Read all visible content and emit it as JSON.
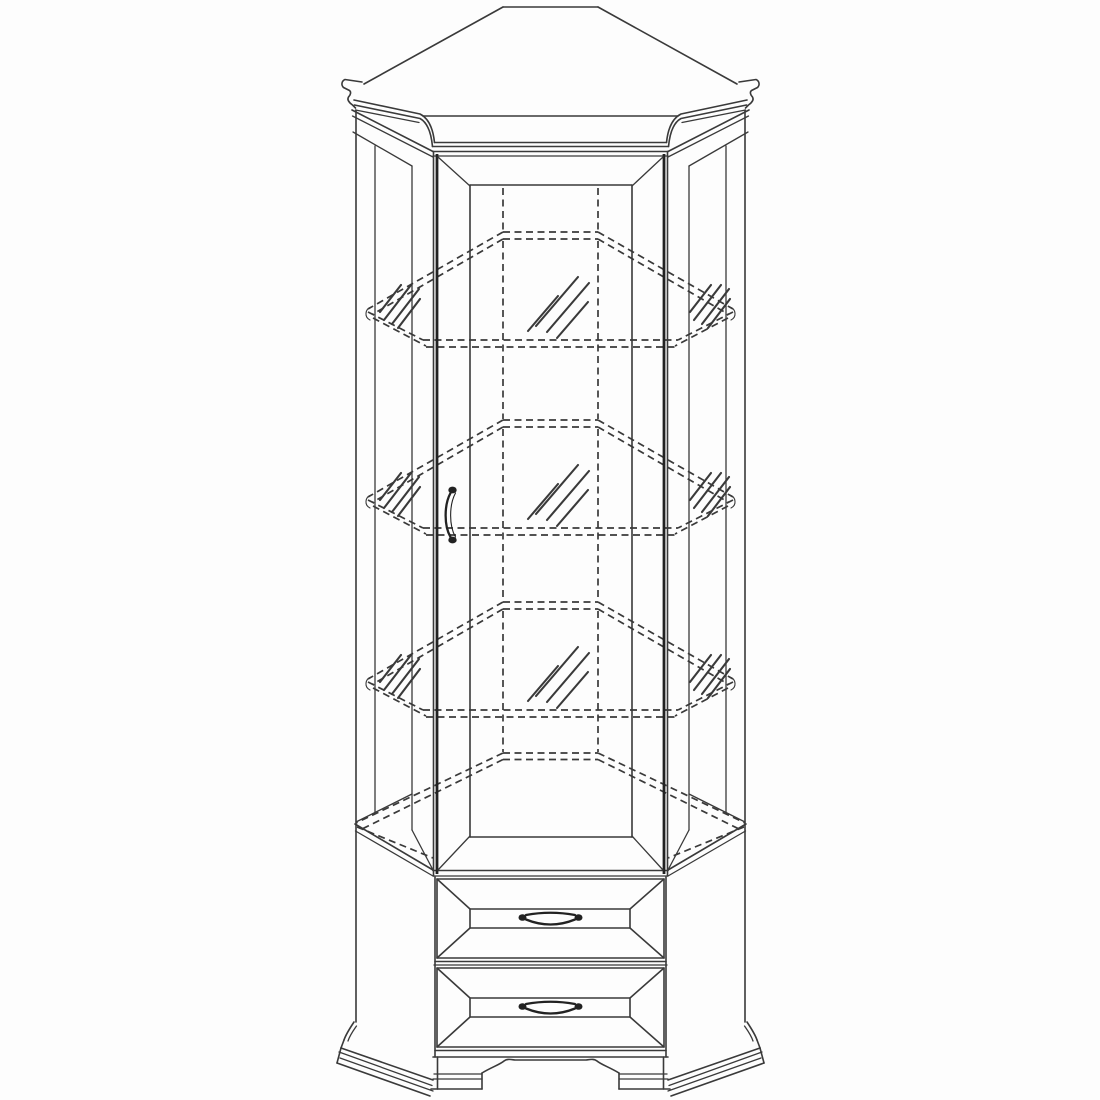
{
  "meta": {
    "document_type": "technical furniture line drawing",
    "subject": "corner display cabinet",
    "view": "front elevation with perspective top",
    "background_color": "#fdfdfd",
    "line_color": "#3a3a3a",
    "dark_line_color": "#222222"
  },
  "cabinet": {
    "crown": {
      "style": "flared cornice with ogee end tips",
      "tip_count": 2
    },
    "door": {
      "count": 1,
      "type": "glazed display door",
      "handle": {
        "type": "curved vertical pull",
        "side": "left",
        "x": 452,
        "y": 515
      }
    },
    "shelves": {
      "count": 3,
      "material": "glass",
      "line_style": "dashed hidden lines",
      "y_offsets": [
        232,
        420,
        602
      ],
      "glass_hatch_groups_per_shelf": 3
    },
    "interior": {
      "floor_y": 753,
      "back_corner_lines_x": [
        503,
        598
      ]
    },
    "drawers": {
      "count": 2,
      "y_positions": [
        879,
        968
      ],
      "front_style": "beveled raised panel",
      "handle": {
        "type": "arched bail pull"
      }
    },
    "base": {
      "plinth": "flared stepped molding",
      "feet": {
        "count": 2,
        "style": "bracket"
      },
      "apron": "scalloped with center plateau"
    }
  }
}
